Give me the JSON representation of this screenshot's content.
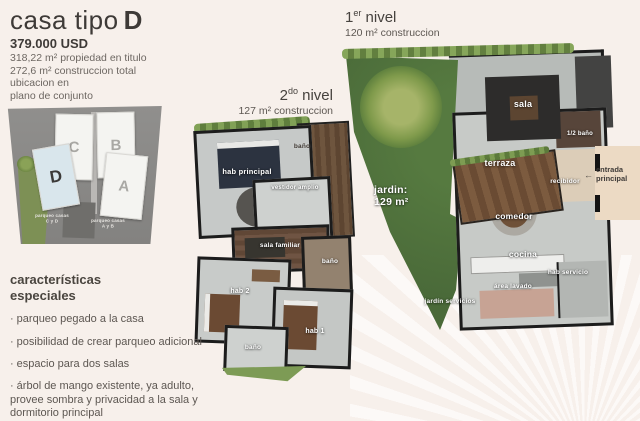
{
  "colors": {
    "background": "#f7f0eb",
    "garden_green": "#4a6a39",
    "highlight_building_d": "#d9e6ec",
    "wood_brown": "#6a4b33",
    "text_dark": "#3e3a37"
  },
  "header": {
    "title_light": "casa tipo",
    "title_bold": "D",
    "price": "379.000 USD",
    "detail1": "318,22 m² propiedad en titulo",
    "detail2": "272,6 m² construccion total",
    "location_caption1": "ubicacion en",
    "location_caption2": "plano de conjunto"
  },
  "site_plan": {
    "buildings": [
      {
        "label": "C"
      },
      {
        "label": "B"
      },
      {
        "label": "A"
      },
      {
        "label": "D"
      }
    ],
    "parking_cd_line1": "parqueo casas",
    "parking_cd_line2": "C y D",
    "parking_ab_line1": "parqueo casas",
    "parking_ab_line2": "A y B"
  },
  "features": {
    "heading1": "características",
    "heading2": "especiales",
    "bullet": "·",
    "items": [
      "parqueo pegado a la casa",
      "posibilidad de crear parqueo adicional",
      "espacio para dos salas",
      "árbol de mango existente, ya adulto, provee sombra y privacidad a la sala y dormitorio principal"
    ]
  },
  "level2": {
    "title_base": "2",
    "title_sup": "do",
    "title_rest": " nivel",
    "subtitle": "127 m² construccion",
    "rooms": {
      "bano_top": "baño",
      "hab_principal": "hab principal",
      "vestidor": "vestidor amplio",
      "sala_familiar": "sala familiar",
      "bano_mid": "baño",
      "hab2": "hab 2",
      "hab1": "hab 1",
      "bano_bottom": "baño"
    }
  },
  "level1": {
    "title_base": "1",
    "title_sup": "er",
    "title_rest": " nivel",
    "subtitle": "120 m² construccion",
    "rooms": {
      "sala": "sala",
      "medio_bano": "1/2 baño",
      "terraza": "terraza",
      "recibidor": "recibidor",
      "comedor": "comedor",
      "cocina": "cocina",
      "hab_servicio": "hab servicio",
      "area_lavado": "área lavado",
      "jardin_servicios": "jardín servicios"
    },
    "garden_label1": "jardin:",
    "garden_label2": "129 m²",
    "entry_arrow": "←",
    "entry_label1": "entrada",
    "entry_label2": "principal"
  }
}
